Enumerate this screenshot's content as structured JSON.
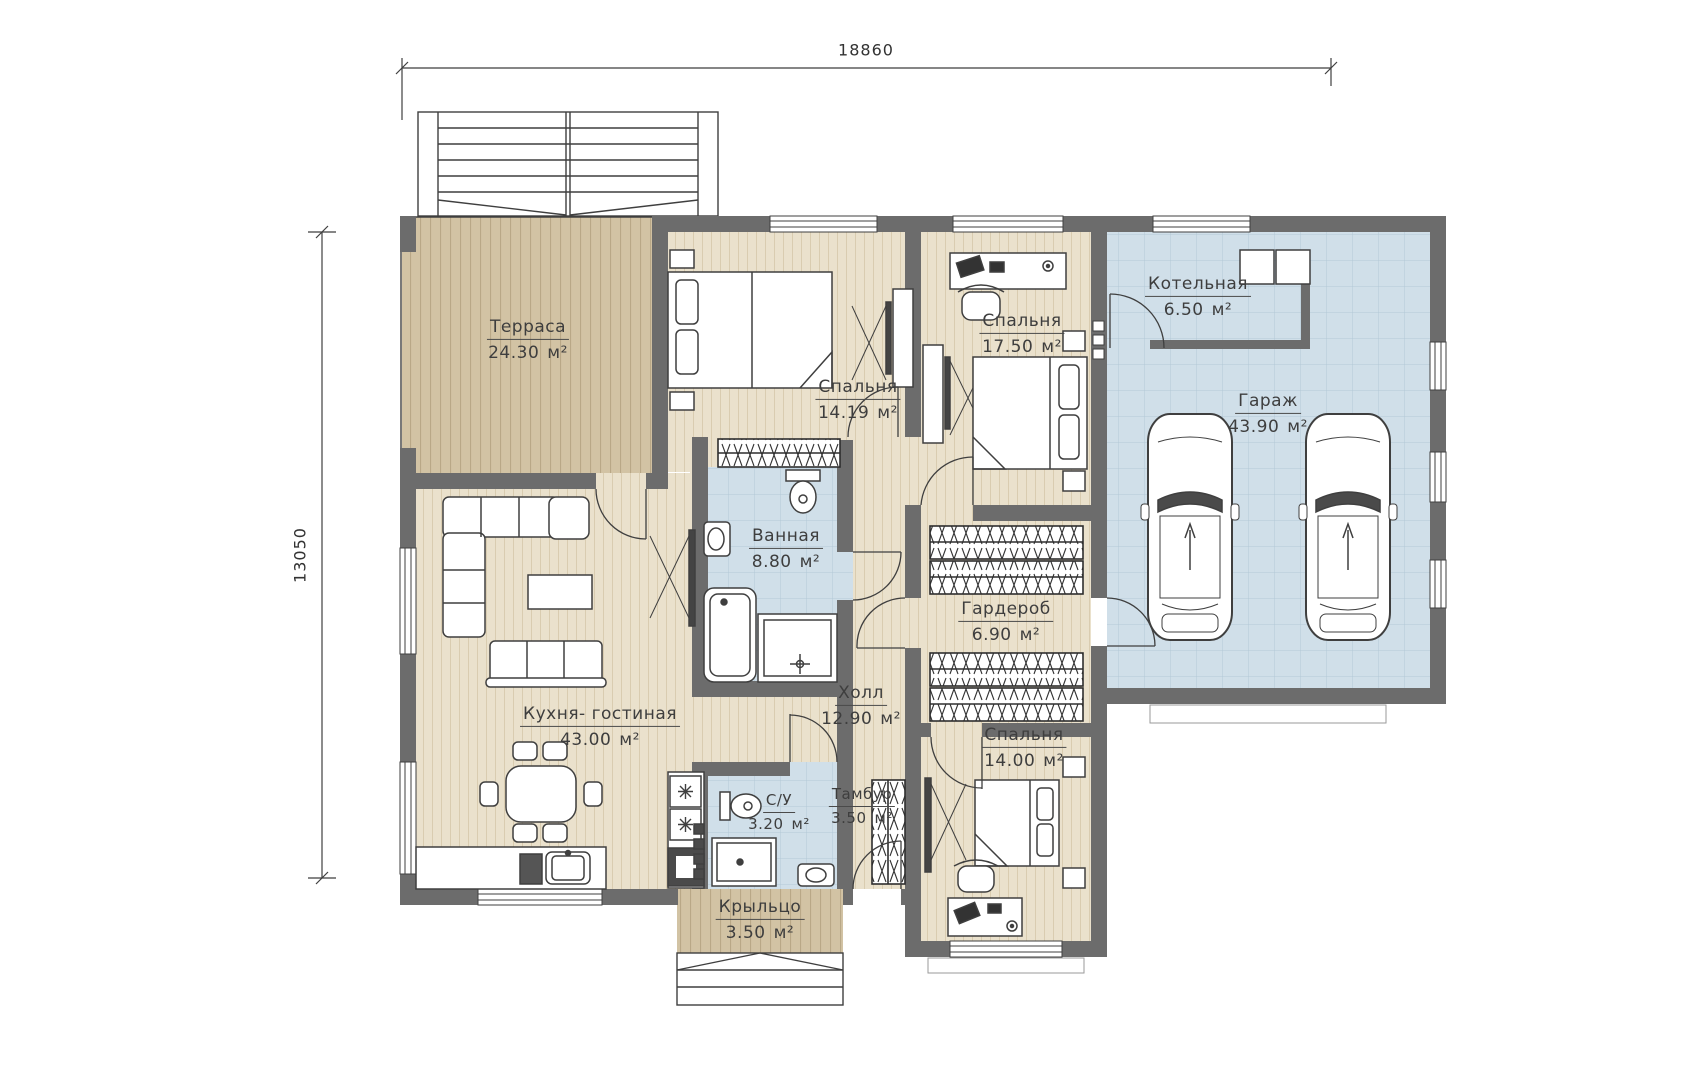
{
  "dimensions": {
    "width_mm": "18860",
    "height_mm": "13050"
  },
  "rooms": [
    {
      "key": "terrace",
      "name": "Терраса",
      "area": "24.30",
      "unit": "м²"
    },
    {
      "key": "bedroom_1",
      "name": "Спальня",
      "area": "14.19",
      "unit": "м²"
    },
    {
      "key": "bedroom_2",
      "name": "Спальня",
      "area": "17.50",
      "unit": "м²"
    },
    {
      "key": "boiler_room",
      "name": "Котельная",
      "area": "6.50",
      "unit": "м²"
    },
    {
      "key": "garage",
      "name": "Гараж",
      "area": "43.90",
      "unit": "м²"
    },
    {
      "key": "bathroom",
      "name": "Ванная",
      "area": "8.80",
      "unit": "м²"
    },
    {
      "key": "wardrobe",
      "name": "Гардероб",
      "area": "6.90",
      "unit": "м²"
    },
    {
      "key": "kitchen_living",
      "name": "Кухня- гостиная",
      "area": "43.00",
      "unit": "м²"
    },
    {
      "key": "hall",
      "name": "Холл",
      "area": "12.90",
      "unit": "м²"
    },
    {
      "key": "wc",
      "name": "С/У",
      "area": "3.20",
      "unit": "м²"
    },
    {
      "key": "vestibule",
      "name": "Тамбур",
      "area": "3.50",
      "unit": "м²"
    },
    {
      "key": "bedroom_3",
      "name": "Спальня",
      "area": "14.00",
      "unit": "м²"
    },
    {
      "key": "porch",
      "name": "Крыльцо",
      "area": "3.50",
      "unit": "м²"
    }
  ],
  "colors": {
    "wall": "#6c6c6c",
    "floor": "#eae1cc",
    "floor_stripe": "#d9ccb0",
    "deck": "#d2c3a4",
    "deck_stripe": "#b9a887",
    "tile": "#d0dfe9",
    "tile_grid": "#b3c9d6",
    "line": "#3f3f3f"
  }
}
